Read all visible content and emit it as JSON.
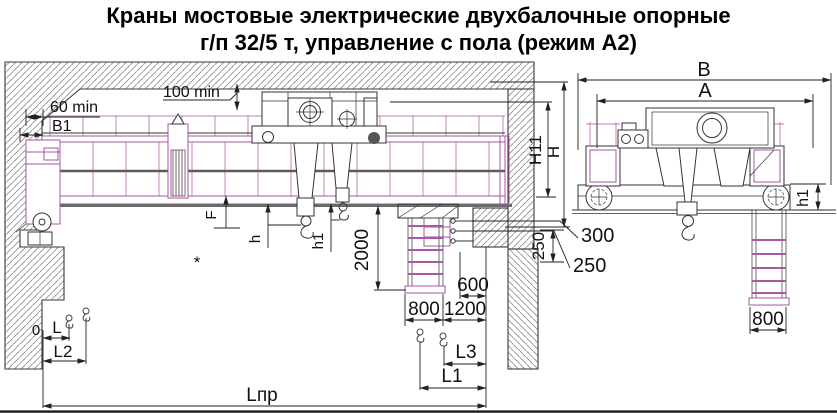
{
  "title": {
    "line1": "Краны мостовые электрические двухбалочные опорные",
    "line2": "г/п 32/5 т, управление с пола (режим А2)"
  },
  "dimensions": {
    "gap_side": "60 min",
    "b1": "B1",
    "gap_top": "100 min",
    "h11": "H11",
    "h_height": "H",
    "b": "B",
    "a": "A",
    "d300": "300",
    "d250_leader": "250",
    "d250_vert": "250",
    "d600": "600",
    "d800": "800",
    "d1200": "1200",
    "d2000": "2000",
    "f": "F",
    "hook_main_h": "h",
    "hook_aux_h1": "h1",
    "asterisk": "*",
    "zero": "0",
    "l": "L",
    "l2": "L2",
    "l3": "L3",
    "l1": "L1",
    "l_span": "Lпр",
    "side_h1": "h1",
    "side_800": "800"
  }
}
